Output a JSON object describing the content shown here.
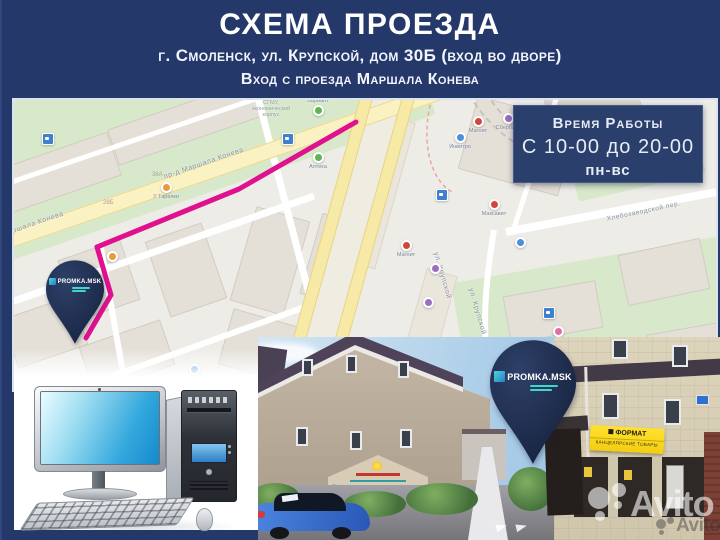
{
  "header": {
    "title": "СХЕМА ПРОЕЗДА",
    "address_line": "г. Смоленск, ул. Крупской, дом 30Б (вход во дворе)",
    "entrance_line": "Вход с проезда Маршала Конева"
  },
  "hours_box": {
    "title": "Время Работы",
    "time": "С 10-00 до 20-00",
    "days": "пн-вс"
  },
  "map": {
    "streets": [
      {
        "text": "пр-д Маршала Конева"
      },
      {
        "text": "пр-д Маршала Конева"
      },
      {
        "text": "ул. Крупской"
      },
      {
        "text": "ул. Крупской"
      },
      {
        "text": "Хлебозаводской пер."
      }
    ],
    "house_numbers": [
      {
        "text": "38А"
      },
      {
        "text": "28Б"
      }
    ],
    "campus": {
      "line1": "СГМУ,",
      "line2": "экономический",
      "line3": "корпус"
    },
    "pois": [
      {
        "kind": "green",
        "label": "Вариант"
      },
      {
        "kind": "green",
        "label": "Аптека"
      },
      {
        "kind": "orange",
        "label": "У Тарелки"
      },
      {
        "kind": "orange",
        "label": ""
      },
      {
        "kind": "red",
        "label": "Магнит"
      },
      {
        "kind": "red",
        "label": "Максавит"
      },
      {
        "kind": "red",
        "label": "Магнит"
      },
      {
        "kind": "purple",
        "label": "Сбербанк"
      },
      {
        "kind": "blue",
        "label": "Инвитро"
      },
      {
        "kind": "blue",
        "label": ""
      },
      {
        "kind": "purple",
        "label": ""
      },
      {
        "kind": "purple",
        "label": ""
      },
      {
        "kind": "pink",
        "label": ""
      },
      {
        "kind": "blue",
        "label": ""
      }
    ],
    "pin": {
      "brand": "PROMKA.MSK"
    }
  },
  "photo": {
    "pin": {
      "brand": "PROMKA.MSK"
    },
    "store_sign": {
      "line1": "ФОРМАТ",
      "line2": "КАНЦЕЛЯРСКИЕ ТОВАРЫ"
    }
  },
  "watermark": {
    "primary": "Avito",
    "secondary": "Avito"
  },
  "colors": {
    "frame_navy": "#24386a",
    "route_magenta": "#e0108f",
    "pin_navy": "#1c2b52",
    "logo_teal": "#3fd6cf",
    "sign_yellow": "#f6d51a"
  }
}
